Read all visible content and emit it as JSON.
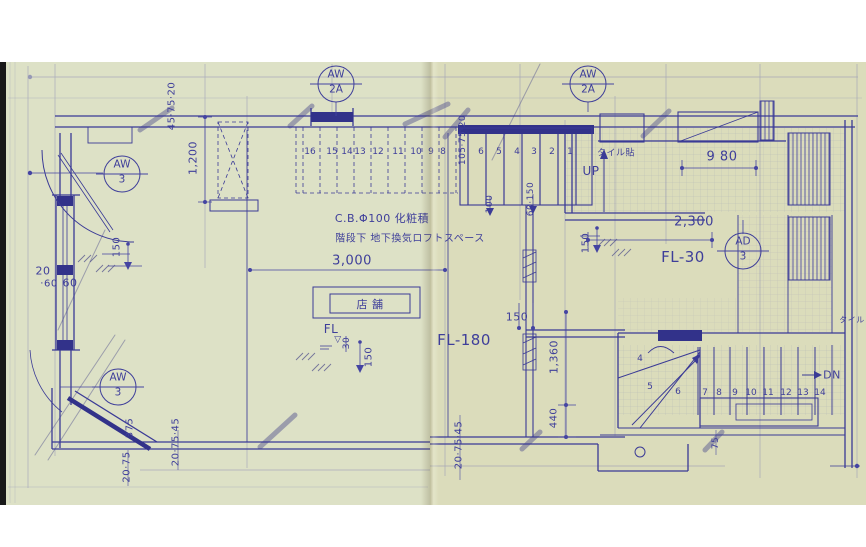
{
  "drawing_type": "architectural floor plan (blueprint, folded print)",
  "colors": {
    "ink": "#3e3e9a",
    "ink_dark": "#32328a",
    "paper": "#dde1c6"
  },
  "callouts": [
    {
      "name": "callout-aw3-upper",
      "top": "AW",
      "bottom": "3",
      "cx": 122,
      "cy": 174
    },
    {
      "name": "callout-aw2a-left",
      "top": "AW",
      "bottom": "2A",
      "cx": 336,
      "cy": 84
    },
    {
      "name": "callout-aw2a-right",
      "top": "AW",
      "bottom": "2A",
      "cx": 588,
      "cy": 84
    },
    {
      "name": "callout-ad3",
      "top": "AD",
      "bottom": "3",
      "cx": 743,
      "cy": 251
    },
    {
      "name": "callout-aw3-lower",
      "top": "AW",
      "bottom": "3",
      "cx": 118,
      "cy": 387
    }
  ],
  "labels": [
    {
      "name": "dim-45-75-20",
      "text": "45·75·20",
      "x": 172,
      "y": 106,
      "rot": -90,
      "size": 10
    },
    {
      "name": "dim-1200",
      "text": "1,200",
      "x": 193,
      "y": 158,
      "rot": -90,
      "size": 11
    },
    {
      "name": "dim-105-75-20",
      "text": "105·75·20",
      "x": 463,
      "y": 140,
      "rot": -90,
      "size": 9
    },
    {
      "name": "note-cb100",
      "text": "C.B.Φ100 化粧積",
      "x": 382,
      "y": 218,
      "rot": 0,
      "size": 11
    },
    {
      "name": "note-under-stair",
      "text": "階段下 地下換気ロフトスペース",
      "x": 410,
      "y": 237,
      "rot": 0,
      "size": 10
    },
    {
      "name": "dim-3000",
      "text": "3,000",
      "x": 352,
      "y": 261,
      "rot": 0,
      "size": 13
    },
    {
      "name": "room-store",
      "text": "店 舗",
      "x": 370,
      "y": 304,
      "rot": 0,
      "size": 11
    },
    {
      "name": "fl-mark",
      "text": "FL",
      "x": 331,
      "y": 329,
      "rot": 0,
      "size": 12
    },
    {
      "name": "fl-triangle",
      "text": "▽",
      "x": 338,
      "y": 340,
      "rot": 0,
      "size": 9
    },
    {
      "name": "dim-30-fl",
      "text": "30",
      "x": 347,
      "y": 343,
      "rot": -90,
      "size": 9
    },
    {
      "name": "dim-150-fl",
      "text": "150",
      "x": 369,
      "y": 357,
      "rot": -90,
      "size": 10
    },
    {
      "name": "fl-180",
      "text": "FL-180",
      "x": 464,
      "y": 340,
      "rot": 0,
      "size": 15
    },
    {
      "name": "dim-150-center",
      "text": "150",
      "x": 517,
      "y": 317,
      "rot": 0,
      "size": 11
    },
    {
      "name": "dim-1360",
      "text": "1,360",
      "x": 554,
      "y": 357,
      "rot": -90,
      "size": 11
    },
    {
      "name": "dim-440",
      "text": "440",
      "x": 554,
      "y": 418,
      "rot": -90,
      "size": 10
    },
    {
      "name": "dim-150-left",
      "text": "150",
      "x": 117,
      "y": 247,
      "rot": -90,
      "size": 10
    },
    {
      "name": "dim-20-left",
      "text": "20",
      "x": 43,
      "y": 271,
      "rot": 0,
      "size": 11
    },
    {
      "name": "dim-60-left",
      "text": "·60",
      "x": 49,
      "y": 284,
      "rot": 0,
      "size": 10
    },
    {
      "name": "dim-60-box",
      "text": "60",
      "x": 70,
      "y": 283,
      "rot": 0,
      "size": 11
    },
    {
      "name": "dim-375",
      "text": "375",
      "x": 130,
      "y": 428,
      "rot": -90,
      "size": 10
    },
    {
      "name": "dim-20-75",
      "text": "20·75",
      "x": 127,
      "y": 467,
      "rot": -90,
      "size": 10
    },
    {
      "name": "dim-20-75-45-left",
      "text": "20·75·45",
      "x": 176,
      "y": 442,
      "rot": -90,
      "size": 10
    },
    {
      "name": "dim-20-75-45-center",
      "text": "20·75·45",
      "x": 459,
      "y": 445,
      "rot": -90,
      "size": 10
    },
    {
      "name": "dim-2300",
      "text": "2,300",
      "x": 694,
      "y": 222,
      "rot": 0,
      "size": 13
    },
    {
      "name": "fl-30",
      "text": "FL-30",
      "x": 683,
      "y": 257,
      "rot": 0,
      "size": 15
    },
    {
      "name": "dim-150-right",
      "text": "150",
      "x": 586,
      "y": 243,
      "rot": -90,
      "size": 10
    },
    {
      "name": "dim-980",
      "text": "9 80",
      "x": 722,
      "y": 157,
      "rot": 0,
      "size": 13
    },
    {
      "name": "note-tile",
      "text": "タイル貼",
      "x": 616,
      "y": 152,
      "rot": 0,
      "size": 9
    },
    {
      "name": "up-label",
      "text": "UP",
      "x": 591,
      "y": 171,
      "rot": 0,
      "size": 12
    },
    {
      "name": "dim-100",
      "text": "100",
      "x": 490,
      "y": 204,
      "rot": -90,
      "size": 9
    },
    {
      "name": "dim-60-150",
      "text": "60·150",
      "x": 531,
      "y": 199,
      "rot": -90,
      "size": 9
    },
    {
      "name": "dn-label",
      "text": "DN",
      "x": 832,
      "y": 375,
      "rot": 0,
      "size": 11
    },
    {
      "name": "dim-75",
      "text": "75",
      "x": 716,
      "y": 443,
      "rot": -90,
      "size": 9
    },
    {
      "name": "note-tile-right",
      "text": "タイル",
      "x": 852,
      "y": 320,
      "rot": 0,
      "size": 8
    }
  ],
  "stairs": [
    {
      "name": "stair-upper-dashed",
      "y": 152,
      "numbers": [
        {
          "t": "16",
          "x": 310
        },
        {
          "t": "15",
          "x": 332
        },
        {
          "t": "14",
          "x": 347
        },
        {
          "t": "13",
          "x": 360
        },
        {
          "t": "12",
          "x": 378
        },
        {
          "t": "11",
          "x": 398
        },
        {
          "t": "10",
          "x": 416
        },
        {
          "t": "9",
          "x": 431
        },
        {
          "t": "8",
          "x": 443
        }
      ]
    },
    {
      "name": "stair-entry",
      "y": 152,
      "numbers": [
        {
          "t": "6",
          "x": 481
        },
        {
          "t": "5",
          "x": 499
        },
        {
          "t": "4",
          "x": 517
        },
        {
          "t": "3",
          "x": 534
        },
        {
          "t": "2",
          "x": 552
        },
        {
          "t": "1",
          "x": 570
        }
      ]
    },
    {
      "name": "stair-lower-winder",
      "y": 0,
      "numbers": [
        {
          "t": "4",
          "x": 640,
          "y": 359
        },
        {
          "t": "5",
          "x": 650,
          "y": 387
        },
        {
          "t": "6",
          "x": 678,
          "y": 392
        }
      ]
    },
    {
      "name": "stair-lower-run",
      "y": 393,
      "numbers": [
        {
          "t": "7",
          "x": 705
        },
        {
          "t": "8",
          "x": 719
        },
        {
          "t": "9",
          "x": 735
        },
        {
          "t": "10",
          "x": 751
        },
        {
          "t": "11",
          "x": 768
        },
        {
          "t": "12",
          "x": 786
        },
        {
          "t": "13",
          "x": 803
        },
        {
          "t": "14",
          "x": 820
        }
      ]
    }
  ]
}
